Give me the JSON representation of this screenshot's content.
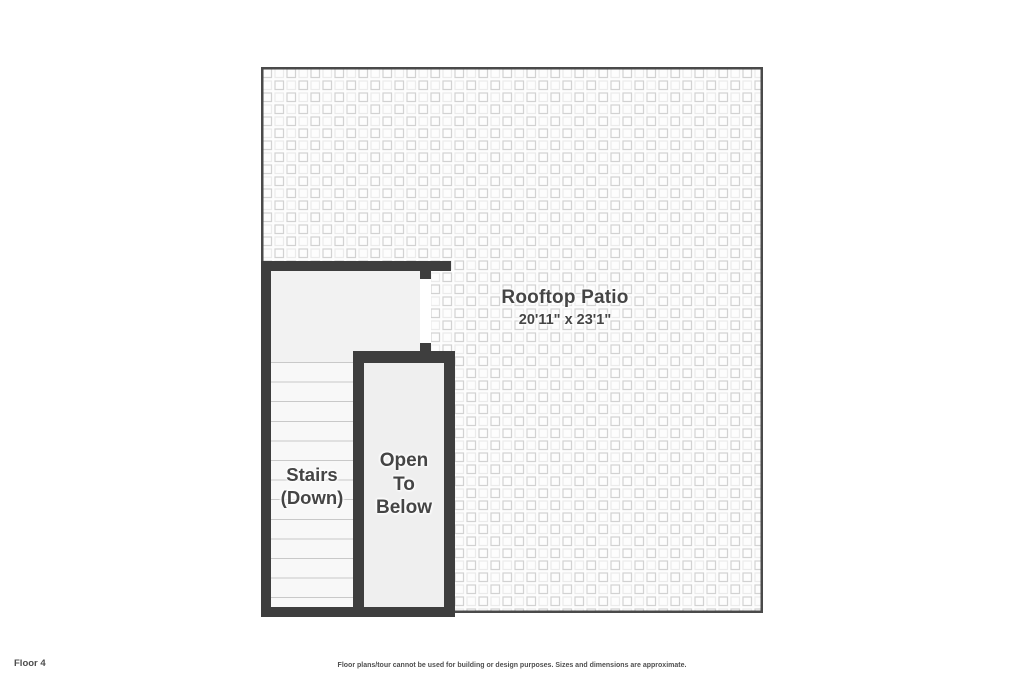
{
  "floor_plan": {
    "floor_label": "Floor 4",
    "disclaimer": "Floor plans/tour cannot be used for building or design purposes. Sizes and dimensions are approximate.",
    "patio": {
      "name": "Rooftop Patio",
      "dimensions": "20'11\" x 23'1\""
    },
    "stairs": {
      "line1": "Stairs",
      "line2": "(Down)"
    },
    "open_to_below": {
      "line1": "Open",
      "line2": "To",
      "line3": "Below"
    },
    "colors": {
      "wall": "#3e3e3e",
      "label_text": "#454545",
      "room_fill": "#f2f2f2",
      "stair_tread_line": "#c9c9c9",
      "patio_border": "#4a4a4a",
      "pattern_line_strong": "#d2d2d2",
      "pattern_line_faint": "#ebebeb"
    }
  }
}
